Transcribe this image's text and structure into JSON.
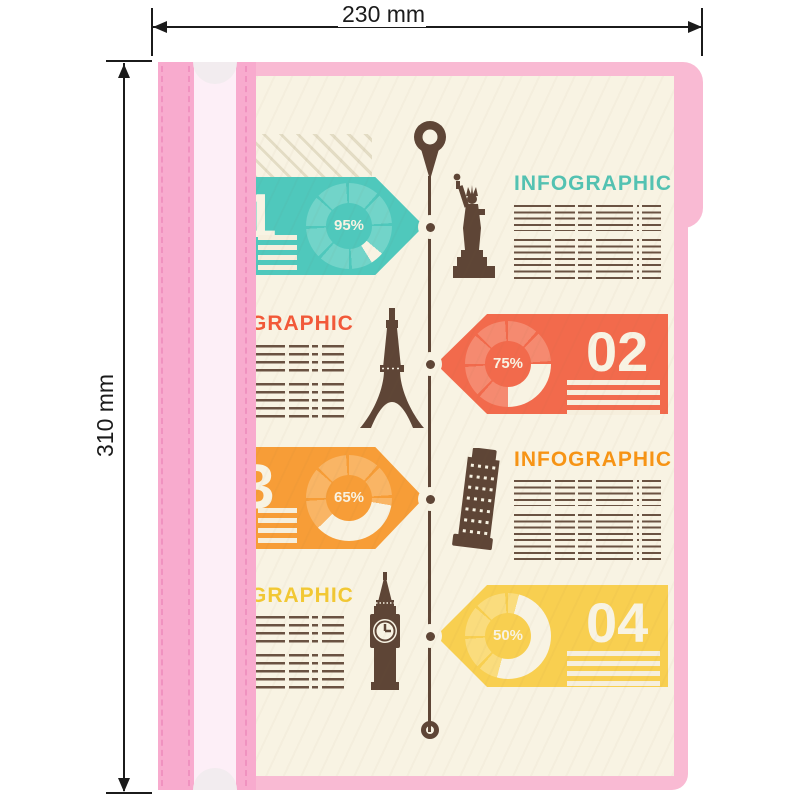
{
  "annotations": {
    "width_label": "230 mm",
    "height_label": "310 mm"
  },
  "folder": {
    "body_color": "#f9bad3",
    "spine_color": "#f8abce",
    "spine_strip_light_color": "#fdeff7",
    "notch_color": "#f2ecef",
    "page_color": "#f8f3e3"
  },
  "infographic": {
    "timeline_color": "#5e4536",
    "pin_icon": "map-pin-icon",
    "sections": [
      {
        "number": "1",
        "percent_label": "95%",
        "percent": 95,
        "side": "left",
        "heading": "INFOGRAPHIC",
        "heading_color": "#53c2b2",
        "tag_color": "#4fc8bc",
        "ring_color": "#72d4c9",
        "landmark": "statue-of-liberty"
      },
      {
        "number": "02",
        "percent_label": "75%",
        "percent": 75,
        "side": "right",
        "heading": "GRAPHIC",
        "heading_color": "#f25939",
        "tag_color": "#f26a4c",
        "ring_color": "#f58a70",
        "landmark": "eiffel-tower"
      },
      {
        "number": "3",
        "percent_label": "65%",
        "percent": 65,
        "side": "left",
        "heading": "INFOGRAPHIC",
        "heading_color": "#f79415",
        "tag_color": "#f79d37",
        "ring_color": "#f9b565",
        "landmark": "pisa-tower"
      },
      {
        "number": "04",
        "percent_label": "50%",
        "percent": 50,
        "side": "right",
        "heading": "GRAPHIC",
        "heading_color": "#f2c834",
        "tag_color": "#f8cf50",
        "ring_color": "#fadc7d",
        "landmark": "big-ben"
      }
    ]
  }
}
